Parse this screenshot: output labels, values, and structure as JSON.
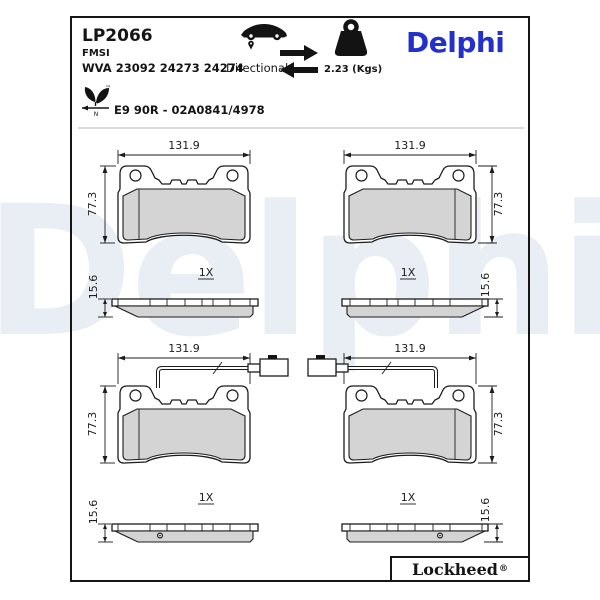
{
  "header": {
    "part_number": "LP2066",
    "fmsi": "FMSI",
    "wva": "WVA 23092 24273 24274",
    "directional": "Directional",
    "weight": "2.23 (Kgs)",
    "brand": "Delphi",
    "approval": "E9 90R - 02A0841/4978",
    "eco_n": "N",
    "eco_tm": "™"
  },
  "dims": {
    "width": "131.9",
    "height": "77.3",
    "thickness": "15.6",
    "qty": "1X"
  },
  "footer": {
    "brand": "Lockheed",
    "reg": "®"
  },
  "watermark": {
    "text": "Delphi"
  },
  "colors": {
    "brand_blue": "#2430cb",
    "friction_gray": "#d4d4d4",
    "watermark": "#e9eef4",
    "line": "#1c1c1c"
  }
}
